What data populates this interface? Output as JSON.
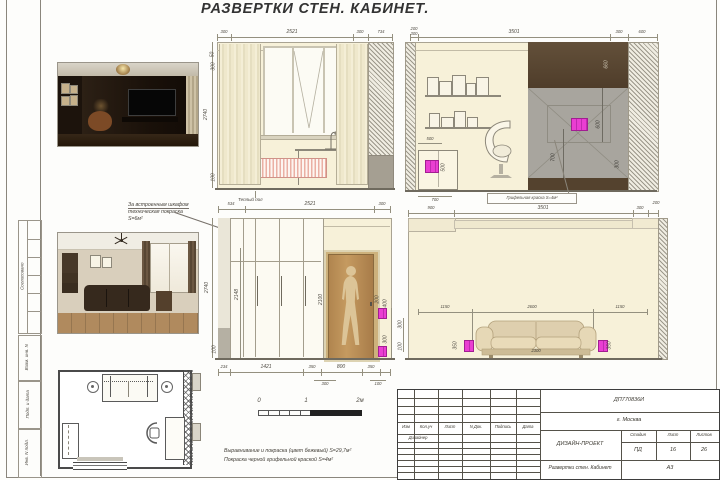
{
  "title": "РАЗВЕРТКИ СТЕН. КАБИНЕТ.",
  "margin": {
    "approved": "Согласовано",
    "vzam": "Взам. инв. N",
    "podp": "Подп. и дата",
    "inv": "Инв. N подл."
  },
  "annotation": {
    "l1": "За встроенным шкафом",
    "l2": "техническая покраска",
    "l3": "S=6м²"
  },
  "elev_window": {
    "dt": [
      "300",
      "2521",
      "300",
      "734"
    ],
    "h": "2740",
    "ts": [
      "50",
      "300"
    ],
    "b": "100",
    "floor_note": "Теплый пол"
  },
  "elev_chalk": {
    "ts": [
      "200",
      "300"
    ],
    "dt": [
      "3501",
      "300",
      "600"
    ],
    "wood_h": "660",
    "panel_v": [
      "600",
      "700",
      "300"
    ],
    "cab_top": "500",
    "cab_side": "500",
    "cab_b": "700",
    "label": "Грифельная краска S=4м²"
  },
  "elev_door": {
    "dt": [
      "534",
      "2521",
      "300"
    ],
    "h": "2740",
    "h2": "2148",
    "door_h": "2100",
    "handle": "200",
    "sv": [
      "400",
      "300"
    ],
    "db": [
      "234",
      "1421",
      "350",
      "800",
      "350"
    ],
    "ds": [
      "300",
      "100"
    ],
    "b": "100"
  },
  "elev_sofa": {
    "dt": [
      "900",
      "3501",
      "300",
      "200"
    ],
    "dm": [
      "1150",
      "2600",
      "1150"
    ],
    "sw": "2300",
    "sh": [
      "350",
      "350"
    ],
    "ls": [
      "300",
      "100"
    ]
  },
  "scalebar": {
    "z": "0",
    "one": "1",
    "two": "2м"
  },
  "notes": {
    "l1": "Выравнивание и покраска (цвет бежевый) S=29,7м²",
    "l2": "Покраска черной грифельной краской S=4м²"
  },
  "titleblock": {
    "code": "ДП770836И",
    "city": "г. Москва",
    "cols": [
      "Изм",
      "Кол.уч",
      "Лист",
      "N Док.",
      "Подпись",
      "Дата"
    ],
    "designer": "Дизайнер",
    "project": "ДИЗАЙН-ПРОЕКТ",
    "doc": "Развертки стен. Кабинет",
    "stage_l": "Стадия",
    "sheet_l": "Лист",
    "sheets_l": "Листов",
    "stage": "ПД",
    "sheet": "16",
    "sheets": "26",
    "format": "А3"
  },
  "colors": {
    "accent_magenta": "#ea3ed2",
    "wall_beige": "#f7f1d9",
    "wood_brown": "#5a4431",
    "chalk_gray": "#a8a59e"
  }
}
